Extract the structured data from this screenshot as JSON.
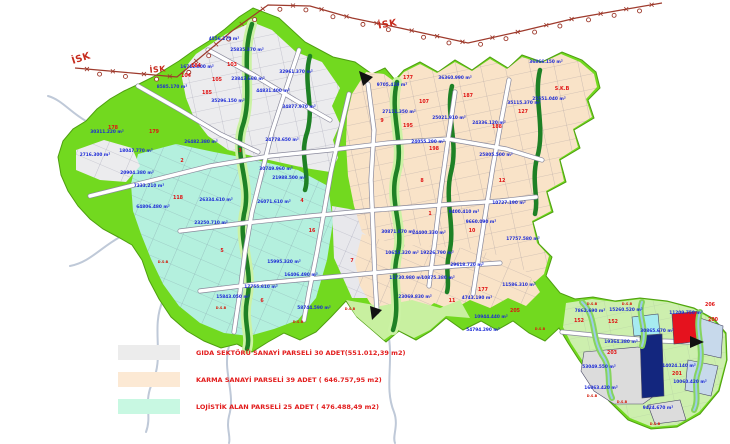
{
  "colors": {
    "boundary": "#72D91F",
    "boundary_edge": "#4E9E10",
    "gida": "#ECECEE",
    "gida2": "#E8E8EC",
    "karma": "#F9E3C8",
    "lojistik": "#B4F0DE",
    "br_base": "#CDEFAE",
    "light_patch": "#C8F0A0",
    "stream": "#1E8125",
    "isk_line": "#9E3A2C",
    "navy_parcel": "#13267E",
    "red_parcel": "#E5121E",
    "cyan_parcel": "#A6EBF0",
    "pale_blue_parcel": "#C7D9EB",
    "gray_parcel": "#DCDCDC",
    "area_text": "#1D2BD6",
    "block_text": "#E01414"
  },
  "isk": {
    "labels": [
      {
        "t": "İSK",
        "x": 82,
        "y": 61,
        "r": -18,
        "s": 9.5
      },
      {
        "t": "İSK",
        "x": 158,
        "y": 72,
        "r": -6,
        "s": 8
      },
      {
        "t": "İSK",
        "x": 388,
        "y": 27,
        "r": -10,
        "s": 9.5
      }
    ]
  },
  "map": {
    "area_labels": [
      {
        "t": "4556.270 m²",
        "x": 224,
        "y": 40
      },
      {
        "t": "25835.370 m²",
        "x": 247,
        "y": 51
      },
      {
        "t": "16712.800 m²",
        "x": 197,
        "y": 68
      },
      {
        "t": "8585.170 m²",
        "x": 172,
        "y": 88
      },
      {
        "t": "23843.660 m²",
        "x": 248,
        "y": 80
      },
      {
        "t": "32961.370 m²",
        "x": 296,
        "y": 73
      },
      {
        "t": "44831.400 m²",
        "x": 273,
        "y": 92
      },
      {
        "t": "35296.150 m²",
        "x": 228,
        "y": 102
      },
      {
        "t": "34877.970 m²",
        "x": 299,
        "y": 108
      },
      {
        "t": "9705.410 m²",
        "x": 392,
        "y": 86
      },
      {
        "t": "36360.990 m²",
        "x": 455,
        "y": 79
      },
      {
        "t": "36866.150 m²",
        "x": 546,
        "y": 63
      },
      {
        "t": "27111.350 m²",
        "x": 399,
        "y": 113
      },
      {
        "t": "25021.910 m²",
        "x": 449,
        "y": 119
      },
      {
        "t": "24336.120 m²",
        "x": 489,
        "y": 124
      },
      {
        "t": "35115.370 m²",
        "x": 524,
        "y": 104
      },
      {
        "t": "25551.040 m²",
        "x": 549,
        "y": 100
      },
      {
        "t": "25805.500 m²",
        "x": 496,
        "y": 156
      },
      {
        "t": "24055.290 m²",
        "x": 428,
        "y": 143
      },
      {
        "t": "24778.650 m²",
        "x": 282,
        "y": 141
      },
      {
        "t": "26482.380 m²",
        "x": 201,
        "y": 143
      },
      {
        "t": "18047.770 m²",
        "x": 136,
        "y": 152
      },
      {
        "t": "20904.380 m²",
        "x": 137,
        "y": 174
      },
      {
        "t": "2716.300 m²",
        "x": 95,
        "y": 156
      },
      {
        "t": "30311.220 m²",
        "x": 107,
        "y": 133
      },
      {
        "t": "30749.960 m²",
        "x": 276,
        "y": 170
      },
      {
        "t": "21988.500 m²",
        "x": 289,
        "y": 179
      },
      {
        "t": "26071.610 m²",
        "x": 274,
        "y": 203
      },
      {
        "t": "26334.610 m²",
        "x": 216,
        "y": 201
      },
      {
        "t": "23250.710 m²",
        "x": 211,
        "y": 224
      },
      {
        "t": "7333.210 m²",
        "x": 149,
        "y": 187
      },
      {
        "t": "64806.480 m²",
        "x": 153,
        "y": 208
      },
      {
        "t": "17755.610 m²",
        "x": 261,
        "y": 288
      },
      {
        "t": "15843.050 m²",
        "x": 233,
        "y": 298
      },
      {
        "t": "15995.320 m²",
        "x": 284,
        "y": 263
      },
      {
        "t": "16406.490 m²",
        "x": 301,
        "y": 276
      },
      {
        "t": "58744.590 m²",
        "x": 314,
        "y": 309
      },
      {
        "t": "30871.870 m²",
        "x": 398,
        "y": 233
      },
      {
        "t": "24400.330 m²",
        "x": 429,
        "y": 234
      },
      {
        "t": "10653.320 m²",
        "x": 402,
        "y": 254
      },
      {
        "t": "19226.790 m²",
        "x": 437,
        "y": 254
      },
      {
        "t": "11730.980 m²",
        "x": 406,
        "y": 279
      },
      {
        "t": "10875.380 m²",
        "x": 438,
        "y": 279
      },
      {
        "t": "9400.410 m²",
        "x": 464,
        "y": 213
      },
      {
        "t": "9660.090 m²",
        "x": 481,
        "y": 223
      },
      {
        "t": "29618.720 m²",
        "x": 467,
        "y": 266
      },
      {
        "t": "11586.310 m²",
        "x": 519,
        "y": 286
      },
      {
        "t": "4743.190 m²",
        "x": 477,
        "y": 299
      },
      {
        "t": "10944.440 m²",
        "x": 491,
        "y": 318
      },
      {
        "t": "54794.290 m²",
        "x": 483,
        "y": 331
      },
      {
        "t": "23069.830 m²",
        "x": 415,
        "y": 298
      },
      {
        "t": "10727.190 m²",
        "x": 509,
        "y": 204
      },
      {
        "t": "17757.580 m²",
        "x": 523,
        "y": 240
      },
      {
        "t": "7862.690 m²",
        "x": 590,
        "y": 312
      },
      {
        "t": "15260.520 m²",
        "x": 626,
        "y": 311
      },
      {
        "t": "11209.750 m²",
        "x": 686,
        "y": 314
      },
      {
        "t": "30865.670 m²",
        "x": 657,
        "y": 332
      },
      {
        "t": "19364.380 m²",
        "x": 621,
        "y": 343
      },
      {
        "t": "53049.550 m²",
        "x": 599,
        "y": 368
      },
      {
        "t": "14024.140 m²",
        "x": 679,
        "y": 367
      },
      {
        "t": "16063.420 m²",
        "x": 601,
        "y": 389
      },
      {
        "t": "9424.670 m²",
        "x": 658,
        "y": 409
      },
      {
        "t": "10060.420 m²",
        "x": 690,
        "y": 383
      }
    ],
    "block_labels": [
      {
        "t": "104",
        "x": 186,
        "y": 77
      },
      {
        "t": "184",
        "x": 196,
        "y": 67
      },
      {
        "t": "105",
        "x": 217,
        "y": 81
      },
      {
        "t": "185",
        "x": 207,
        "y": 94
      },
      {
        "t": "103",
        "x": 232,
        "y": 66
      },
      {
        "t": "178",
        "x": 113,
        "y": 129
      },
      {
        "t": "179",
        "x": 154,
        "y": 133
      },
      {
        "t": "118",
        "x": 178,
        "y": 199
      },
      {
        "t": "177",
        "x": 408,
        "y": 79
      },
      {
        "t": "107",
        "x": 424,
        "y": 103
      },
      {
        "t": "127",
        "x": 523,
        "y": 113
      },
      {
        "t": "187",
        "x": 468,
        "y": 97
      },
      {
        "t": "188",
        "x": 497,
        "y": 128
      },
      {
        "t": "195",
        "x": 408,
        "y": 127
      },
      {
        "t": "198",
        "x": 434,
        "y": 150
      },
      {
        "t": "205",
        "x": 515,
        "y": 312
      },
      {
        "t": "177",
        "x": 483,
        "y": 291
      },
      {
        "t": "152",
        "x": 579,
        "y": 322
      },
      {
        "t": "152",
        "x": 613,
        "y": 323
      },
      {
        "t": "203",
        "x": 612,
        "y": 354
      },
      {
        "t": "200",
        "x": 713,
        "y": 321
      },
      {
        "t": "201",
        "x": 677,
        "y": 375
      },
      {
        "t": "206",
        "x": 710,
        "y": 306
      },
      {
        "t": "S.K.B",
        "x": 562,
        "y": 90
      },
      {
        "t": "3",
        "x": 240,
        "y": 152
      },
      {
        "t": "2",
        "x": 182,
        "y": 162
      },
      {
        "t": "5",
        "x": 222,
        "y": 252
      },
      {
        "t": "6",
        "x": 262,
        "y": 302
      },
      {
        "t": "4",
        "x": 302,
        "y": 202
      },
      {
        "t": "7",
        "x": 352,
        "y": 262
      },
      {
        "t": "9",
        "x": 382,
        "y": 122
      },
      {
        "t": "8",
        "x": 422,
        "y": 182
      },
      {
        "t": "10",
        "x": 472,
        "y": 232
      },
      {
        "t": "11",
        "x": 452,
        "y": 302
      },
      {
        "t": "12",
        "x": 502,
        "y": 182
      },
      {
        "t": "16",
        "x": 312,
        "y": 232
      },
      {
        "t": "1",
        "x": 430,
        "y": 215
      }
    ],
    "dsb_labels": [
      {
        "t": "D.S.B",
        "x": 163,
        "y": 263
      },
      {
        "t": "D.S.B",
        "x": 221,
        "y": 309
      },
      {
        "t": "D.S.B",
        "x": 298,
        "y": 323
      },
      {
        "t": "D.S.B",
        "x": 350,
        "y": 310
      },
      {
        "t": "D.S.B",
        "x": 592,
        "y": 305
      },
      {
        "t": "D.S.B",
        "x": 627,
        "y": 305
      },
      {
        "t": "D.S.B",
        "x": 592,
        "y": 397
      },
      {
        "t": "D.S.B",
        "x": 622,
        "y": 403
      },
      {
        "t": "D.S.B",
        "x": 655,
        "y": 425
      },
      {
        "t": "D.S.B",
        "x": 540,
        "y": 330
      }
    ]
  },
  "legend": {
    "items": [
      {
        "swatch": "#ECECEC",
        "label": "GIDA SEKTÖRÜ SANAYİ PARSELİ 30 ADET(551.012,39 m2)"
      },
      {
        "swatch": "#FCE9D4",
        "label": "KARMA SANAYİ PARSELİ 39 ADET ( 646.757,95 m2)"
      },
      {
        "swatch": "#C8F8E2",
        "label": "LOJİSTİK ALAN  PARSELİ 25 ADET ( 476.488,49 m2)"
      }
    ]
  }
}
